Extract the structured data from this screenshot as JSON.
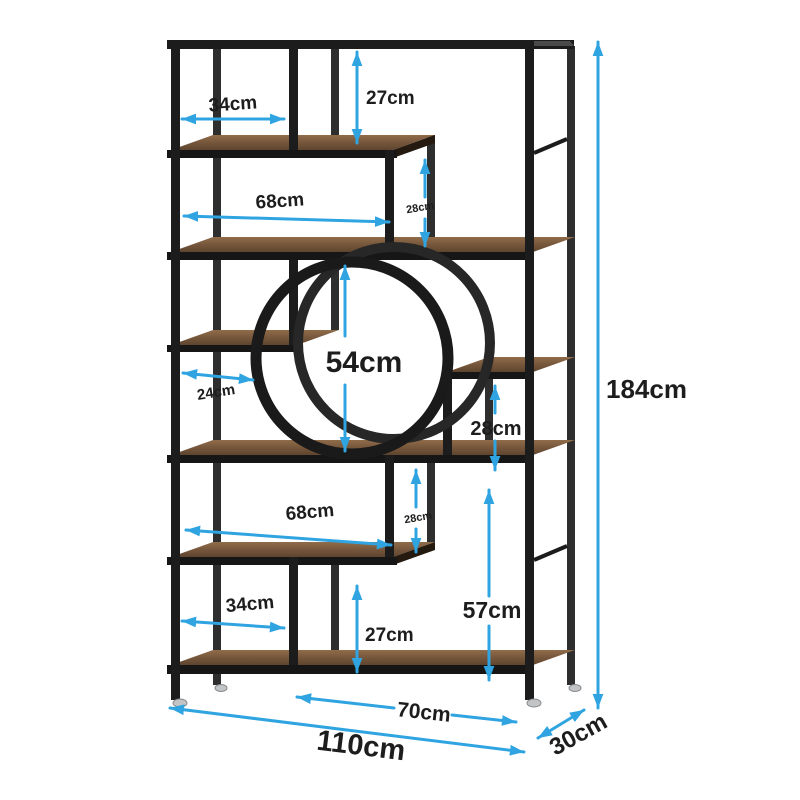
{
  "diagram": {
    "type": "furniture-dimension-diagram",
    "product": "industrial etagere bookshelf with circle accent",
    "unit": "cm",
    "overall": {
      "width": "110cm",
      "depth": "30cm",
      "height": "184cm"
    },
    "colors": {
      "arrow": "#2fa4e1",
      "frame": "#1c1c1c",
      "wood": "#7d5e43",
      "label": "#1d1d1d",
      "background": "#ffffff"
    },
    "dims": [
      {
        "id": "top-left-opening-width",
        "label": "34cm"
      },
      {
        "id": "top-opening-height",
        "label": "27cm"
      },
      {
        "id": "upper-opening-width",
        "label": "68cm"
      },
      {
        "id": "upper-step-height",
        "label": "28cm"
      },
      {
        "id": "circle-opening-height",
        "label": "54cm"
      },
      {
        "id": "middle-left-opening-width",
        "label": "24cm"
      },
      {
        "id": "middle-right-opening-height",
        "label": "28cm"
      },
      {
        "id": "lower-opening-width",
        "label": "68cm"
      },
      {
        "id": "lower-step-height",
        "label": "28cm"
      },
      {
        "id": "bottom-left-opening-width",
        "label": "34cm"
      },
      {
        "id": "bottom-opening-height",
        "label": "27cm"
      },
      {
        "id": "bottom-right-opening-height",
        "label": "57cm"
      },
      {
        "id": "overall-height",
        "label": "184cm"
      },
      {
        "id": "bottom-shelf-width",
        "label": "70cm"
      },
      {
        "id": "overall-width",
        "label": "110cm"
      },
      {
        "id": "overall-depth",
        "label": "30cm"
      }
    ]
  }
}
